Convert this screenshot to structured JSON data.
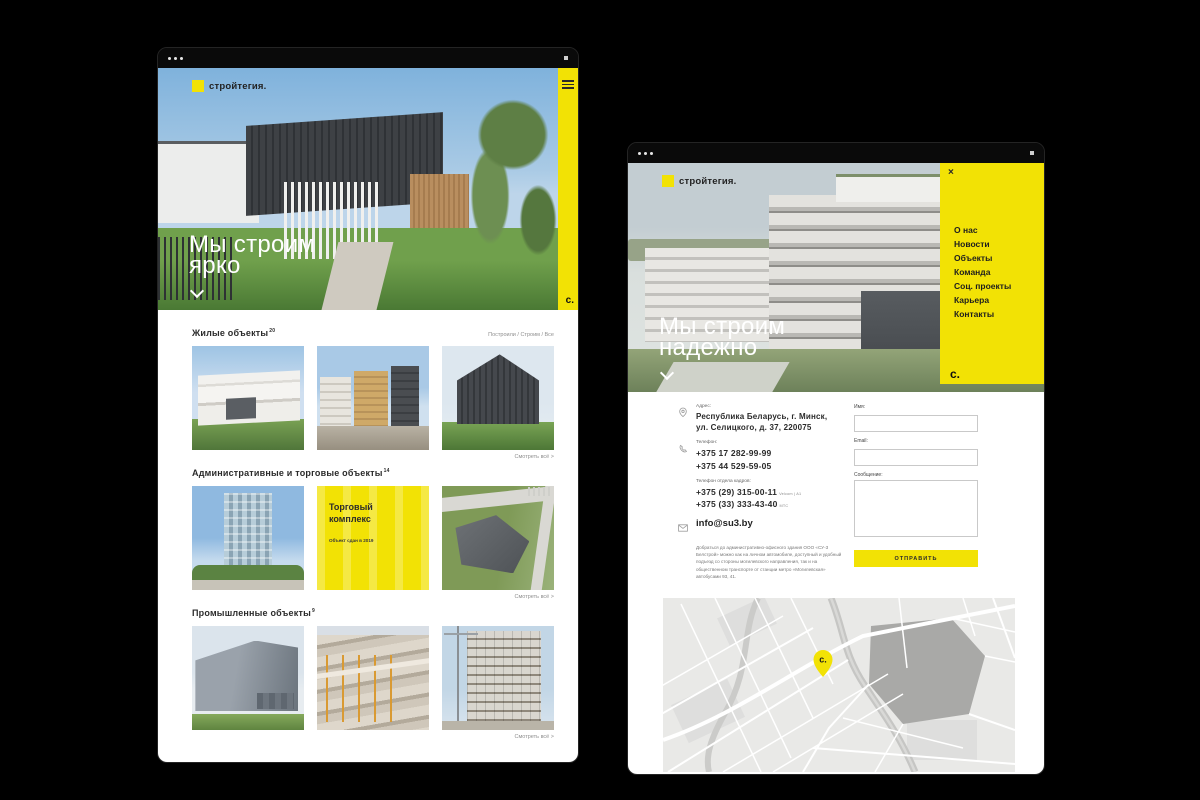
{
  "colors": {
    "accent": "#F2E205"
  },
  "brand": {
    "logo_text": "стройтегия.",
    "mark": "с."
  },
  "left_window": {
    "hero": {
      "line1": "Мы строим",
      "line2": "ярко"
    },
    "filter_label": "Построили / Строим / Все",
    "view_all": {
      "label": "Смотреть всё",
      "arrow": ">"
    },
    "sections": [
      {
        "title": "Жилые объекты",
        "count": "20"
      },
      {
        "title": "Административные и торговые объекты",
        "count": "14"
      },
      {
        "title": "Промышленные объекты",
        "count": "9"
      }
    ],
    "featured_card": {
      "title": "Торговый комплекс",
      "subtitle": "Объект сдан в 2019"
    }
  },
  "right_window": {
    "hero": {
      "line1": "Мы строим",
      "line2": "надежно"
    },
    "menu": {
      "close_icon": "×",
      "items": [
        "О нас",
        "Новости",
        "Объекты",
        "Команда",
        "Соц. проекты",
        "Карьера",
        "Контакты"
      ]
    },
    "contacts": {
      "address_label": "Адрес:",
      "address_line1": "Республика Беларусь, г. Минск,",
      "address_line2": "ул. Селицкого, д. 37, 220075",
      "phone_label": "Телефон:",
      "phone1": "+375 17 282-99-99",
      "phone2": "+375 44 529-59-05",
      "hr_label": "Телефон отдела кадров:",
      "hr_phone1": "+375 (29) 315-00-11",
      "hr_operator1": "Velcom | A1",
      "hr_phone2": "+375 (33) 333-43-40",
      "hr_operator2": "МТС",
      "email": "info@su3.by",
      "directions": "Добраться до административно-офисного здания ООО «СУ-3 Белстрой» можно как на личном автомобиле, доступный и удобный подъезд со стороны могилевского направления, так и на общественном транспорте от станции метро «Могилевская» автобусами 93, 41."
    },
    "form": {
      "name_label": "Имя:",
      "email_label": "Email:",
      "message_label": "Сообщение:",
      "submit_label": "ОТПРАВИТЬ"
    }
  }
}
